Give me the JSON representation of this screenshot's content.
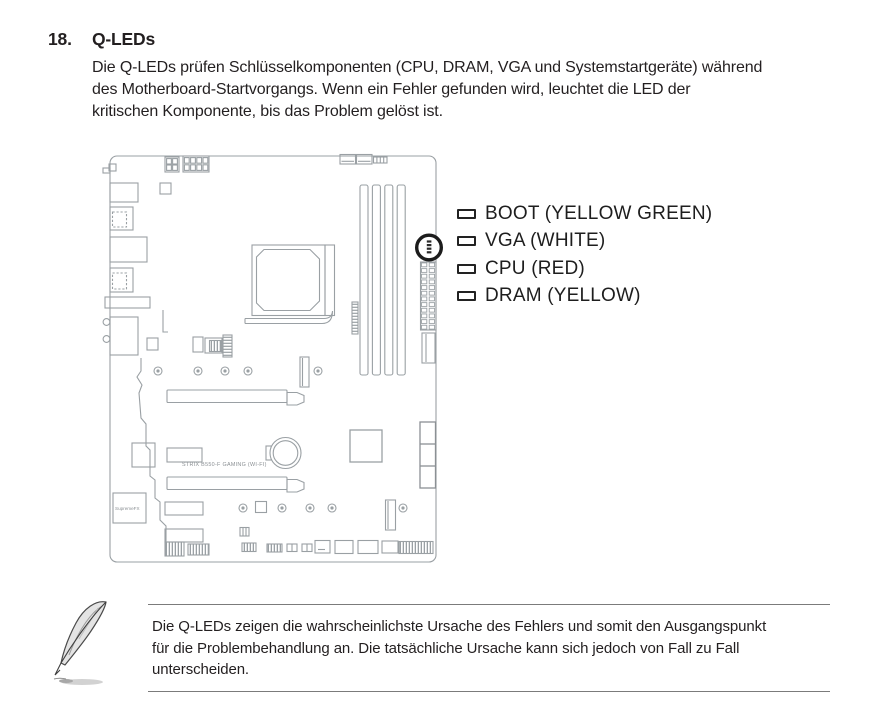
{
  "document": {
    "section_number": "18.",
    "section_title": "Q-LEDs",
    "intro_lines": [
      "Die Q-LEDs prüfen Schlüsselkomponenten (CPU, DRAM, VGA und Systemstartgeräte) während",
      "des Motherboard-Startvorgangs. Wenn ein Fehler gefunden wird, leuchtet die LED der",
      "kritischen Komponente, bis das Problem gelöst ist."
    ]
  },
  "diagram": {
    "board_name": "STRIX B550-F GAMING (WI-FI)",
    "audio_chip_label": "SupremeFX",
    "legend": [
      {
        "label": "BOOT (YELLOW GREEN)"
      },
      {
        "label": "VGA (WHITE)"
      },
      {
        "label": "CPU (RED)"
      },
      {
        "label": "DRAM (YELLOW)"
      }
    ]
  },
  "note": {
    "lines": [
      "Die Q-LEDs zeigen die wahrscheinlichste Ursache des Fehlers und somit den Ausgangspunkt",
      "für die Problembehandlung an. Die tatsächliche Ursache kann sich jedoch von Fall zu Fall",
      "unterscheiden."
    ]
  },
  "colors": {
    "text": "#231f20",
    "diagram_line": "#9aa0a4",
    "qled_ring": "#1c1c1c"
  }
}
